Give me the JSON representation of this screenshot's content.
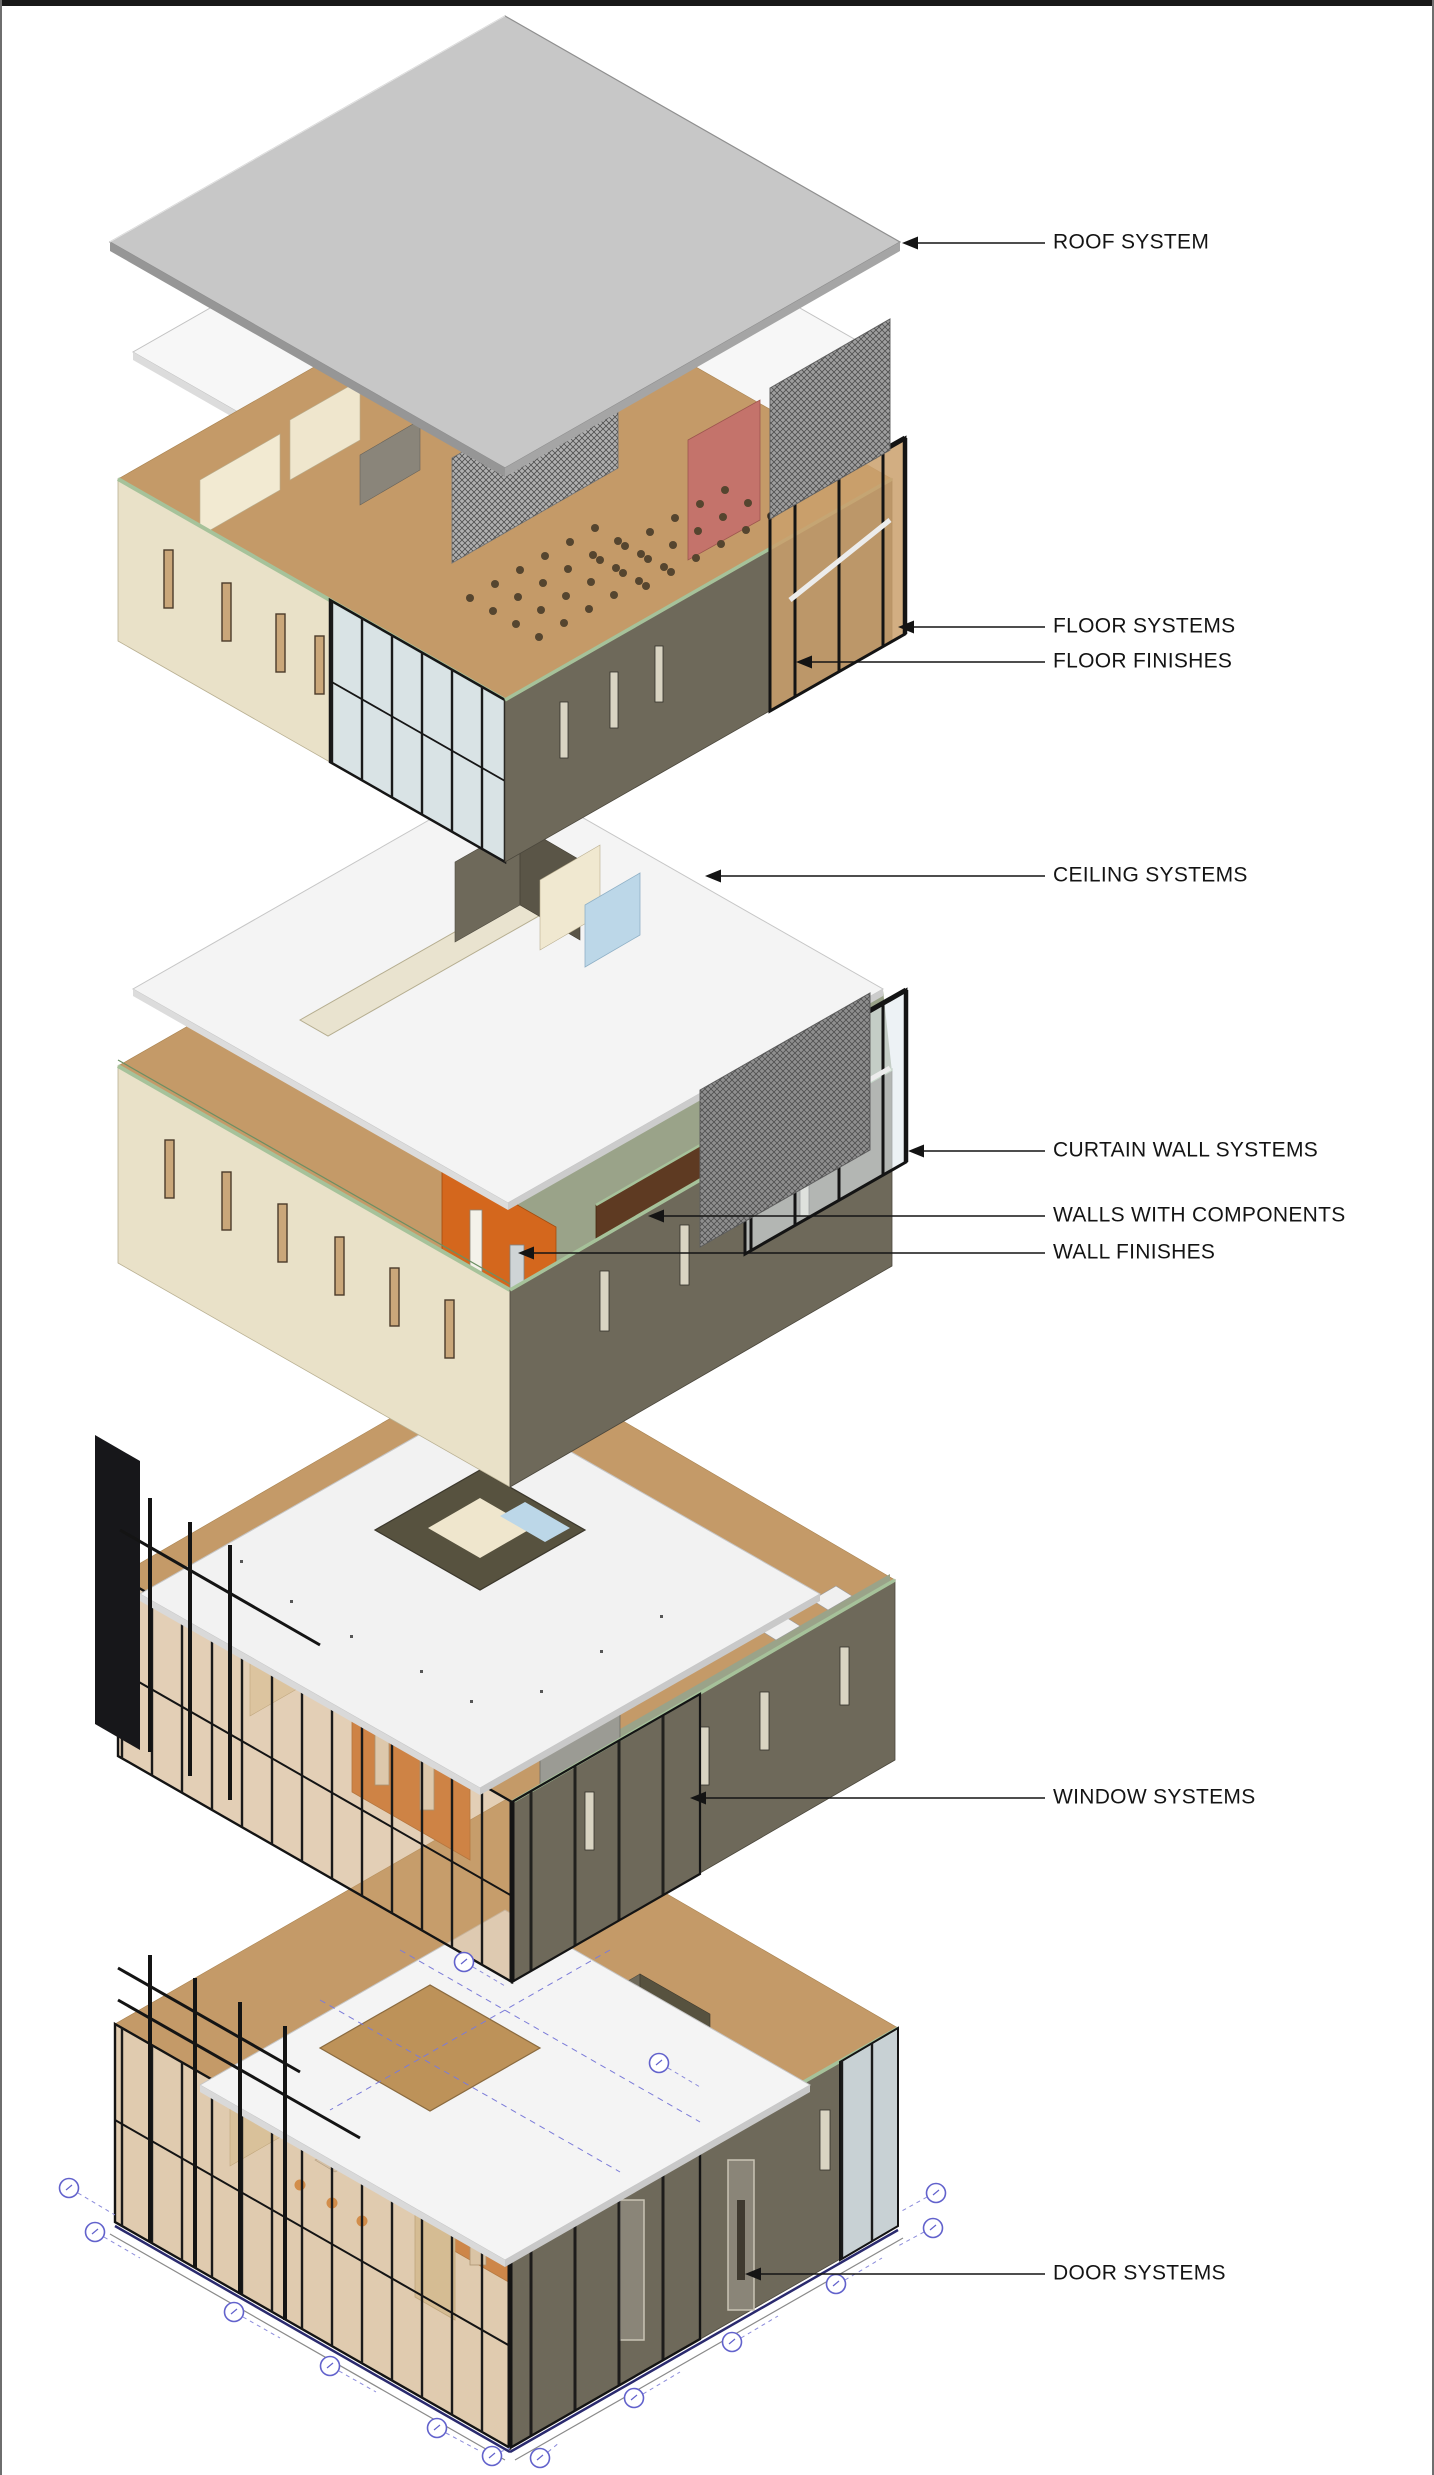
{
  "page": {
    "background": "#ffffff",
    "top_bar_color": "#191919",
    "frame_color": "#6e6e6e"
  },
  "diagram": {
    "type": "exploded-axonometric-building-systems",
    "callouts": [
      {
        "id": "roof-system",
        "label": "ROOF SYSTEM",
        "text_x": 1053,
        "text_y": 243,
        "tip_x": 902,
        "tip_y": 243
      },
      {
        "id": "floor-systems",
        "label": "FLOOR SYSTEMS",
        "text_x": 1053,
        "text_y": 626,
        "tip_x": 898,
        "tip_y": 627
      },
      {
        "id": "floor-finishes",
        "label": "FLOOR FINISHES",
        "text_x": 1053,
        "text_y": 663,
        "tip_x": 796,
        "tip_y": 662
      },
      {
        "id": "ceiling-systems",
        "label": "CEILING SYSTEMS",
        "text_x": 1053,
        "text_y": 874,
        "tip_x": 705,
        "tip_y": 876
      },
      {
        "id": "curtain-wall-systems",
        "label": "CURTAIN WALL SYSTEMS",
        "text_x": 1053,
        "text_y": 1151,
        "tip_x": 908,
        "tip_y": 1151
      },
      {
        "id": "walls-with-components",
        "label": "WALLS WITH COMPONENTS",
        "text_x": 1053,
        "text_y": 1216,
        "tip_x": 648,
        "tip_y": 1216
      },
      {
        "id": "wall-finishes",
        "label": "WALL FINISHES",
        "text_x": 1053,
        "text_y": 1253,
        "tip_x": 518,
        "tip_y": 1253
      },
      {
        "id": "window-systems",
        "label": "WINDOW SYSTEMS",
        "text_x": 1053,
        "text_y": 1798,
        "tip_x": 690,
        "tip_y": 1798
      },
      {
        "id": "door-systems",
        "label": "DOOR SYSTEMS",
        "text_x": 1053,
        "text_y": 2274,
        "tip_x": 745,
        "tip_y": 2274
      }
    ],
    "colors": {
      "roof_gray": "#c7c7c7",
      "slab_white": "#f4f4f4",
      "wall_beige": "#e9e1c8",
      "wall_olive": "#6e695a",
      "accent_orange": "#d4671d",
      "accent_orange_dark": "#b85512",
      "wood_floor": "#c49a68",
      "carpet_olive": "#9aa389",
      "mullion_black": "#161616",
      "trim_green": "#a6c29a",
      "red_wall": "#c4736b",
      "grid_bubble_blue": "#6262cc",
      "leader_black": "#141414"
    }
  }
}
